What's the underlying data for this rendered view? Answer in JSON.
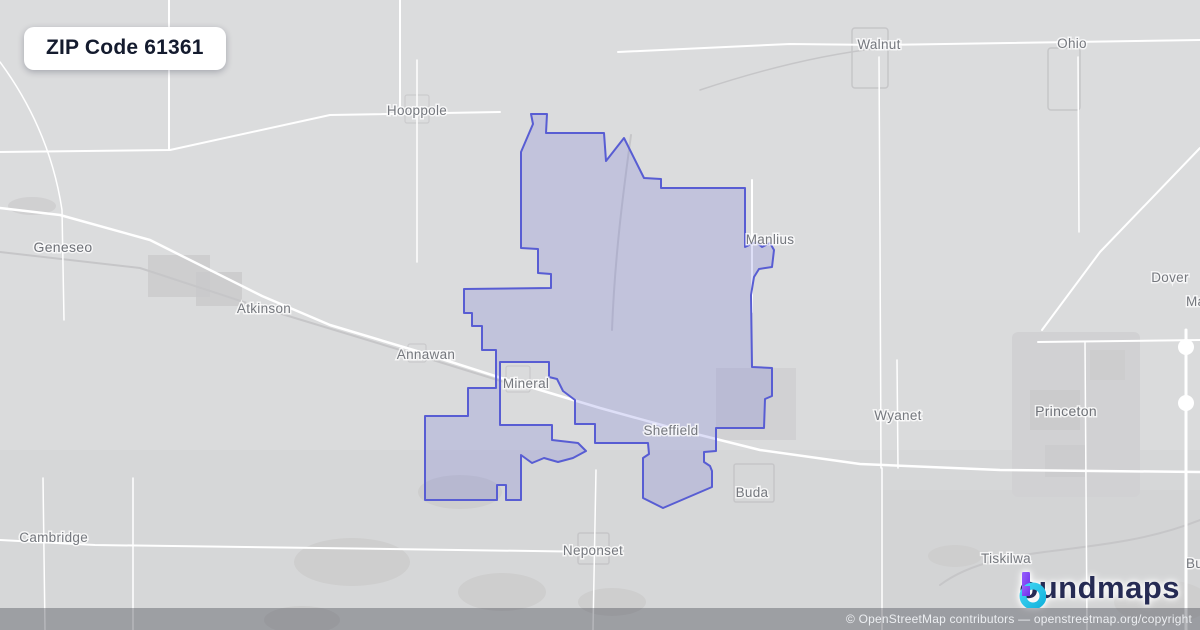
{
  "page": {
    "width": 1200,
    "height": 630,
    "background": "#dadbdc"
  },
  "badge": {
    "label": "ZIP Code 61361"
  },
  "boundary": {
    "zip": "61361",
    "stroke": "#585dd3",
    "fill": "rgba(105,110,220,0.22)",
    "path": "M533,124 L531,114 L547,114 L546,133 L604,133 L606,161 L624,138 L644,178 L661,179 L661,188 L745,188 L745,247 L756,242 L762,247 L770,243 L774,250 L772,267 L759,269 L754,277 L751,295 L752,367 L772,368 L772,396 L765,399 L764,428 L716,428 L716,451 L704,452 L704,462 L710,466 L712,471 L712,487 L663,508 L643,498 L643,458 L649,454 L648,443 L595,443 L595,424 L575,424 L575,400 L563,391 L557,379 L549,377 L549,362 L500,362 L500,425 L552,425 L552,440 L578,443 L586,451 L573,458 L558,462 L544,458 L532,463 L521,455 L521,500 L506,500 L506,485 L497,485 L497,500 L425,500 L425,416 L468,416 L468,388 L496,388 L496,350 L482,350 L482,326 L472,326 L472,313 L464,313 L464,289 L551,288 L551,274 L538,273 L538,249 L521,248 L521,152 Z"
  },
  "towns": [
    {
      "name": "Hooppole",
      "x": 417,
      "y": 115,
      "anchor": "middle",
      "big": false
    },
    {
      "name": "Geneseo",
      "x": 63,
      "y": 252,
      "anchor": "middle",
      "big": true
    },
    {
      "name": "Atkinson",
      "x": 264,
      "y": 313,
      "anchor": "middle",
      "big": false
    },
    {
      "name": "Annawan",
      "x": 426,
      "y": 359,
      "anchor": "middle",
      "big": false
    },
    {
      "name": "Mineral",
      "x": 526,
      "y": 388,
      "anchor": "middle",
      "big": false
    },
    {
      "name": "Sheffield",
      "x": 671,
      "y": 435,
      "anchor": "middle",
      "big": false
    },
    {
      "name": "Manlius",
      "x": 770,
      "y": 244,
      "anchor": "middle",
      "big": false
    },
    {
      "name": "Walnut",
      "x": 879,
      "y": 49,
      "anchor": "middle",
      "big": false
    },
    {
      "name": "Ohio",
      "x": 1072,
      "y": 48,
      "anchor": "middle",
      "big": false
    },
    {
      "name": "Dover",
      "x": 1170,
      "y": 282,
      "anchor": "middle",
      "big": false
    },
    {
      "name": "Malden",
      "x": 1186,
      "y": 306,
      "anchor": "start",
      "big": false
    },
    {
      "name": "Wyanet",
      "x": 898,
      "y": 420,
      "anchor": "middle",
      "big": false
    },
    {
      "name": "Princeton",
      "x": 1066,
      "y": 416,
      "anchor": "middle",
      "big": true
    },
    {
      "name": "Buda",
      "x": 752,
      "y": 497,
      "anchor": "middle",
      "big": false
    },
    {
      "name": "Neponset",
      "x": 593,
      "y": 555,
      "anchor": "middle",
      "big": false
    },
    {
      "name": "Tiskilwa",
      "x": 1006,
      "y": 563,
      "anchor": "middle",
      "big": false
    },
    {
      "name": "Cambridge",
      "x": 88,
      "y": 542,
      "anchor": "end",
      "big": false
    },
    {
      "name": "Bureau",
      "x": 1186,
      "y": 568,
      "anchor": "start",
      "big": false
    }
  ],
  "logo": {
    "b_glyph": "b",
    "rest": "oundmaps",
    "purple": "#7b3ff2",
    "cyan": "#27c4ea",
    "navy": "#262b54"
  },
  "attribution": {
    "text": "© OpenStreetMap contributors — openstreetmap.org/copyright"
  }
}
